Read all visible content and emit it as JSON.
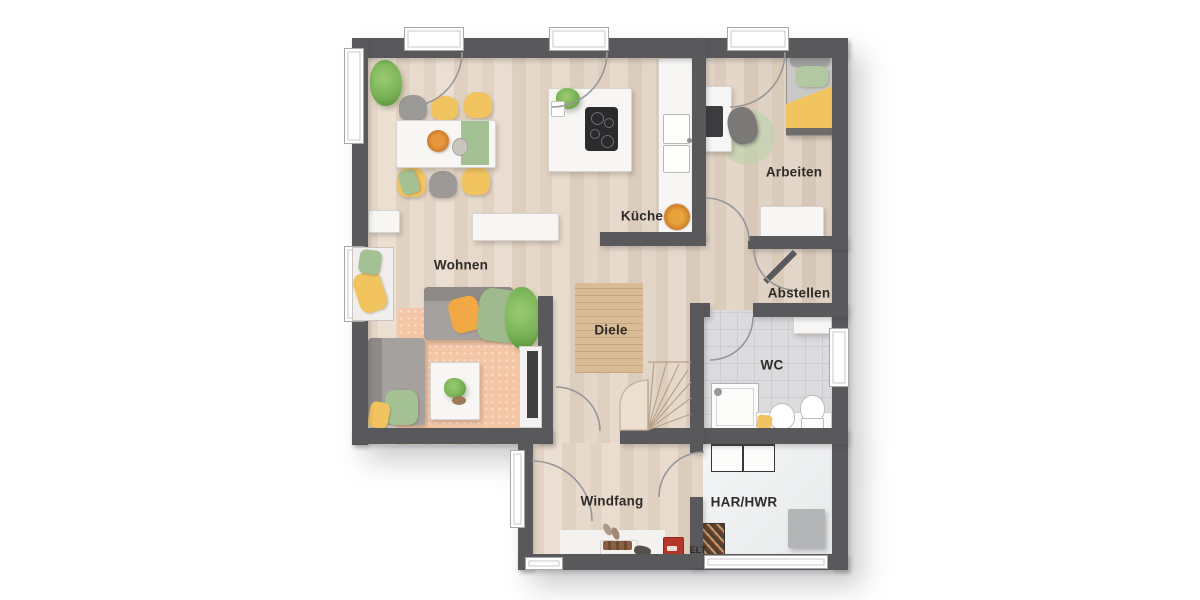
{
  "meta": {
    "type": "floor-plan",
    "level": "ground-floor"
  },
  "rooms": {
    "wohnen": {
      "label": "Wohnen"
    },
    "kueche": {
      "label": "Küche"
    },
    "arbeiten": {
      "label": "Arbeiten"
    },
    "abstellen": {
      "label": "Abstellen"
    },
    "diele": {
      "label": "Diele"
    },
    "wc": {
      "label": "WC"
    },
    "windfang": {
      "label": "Windfang"
    },
    "har_hwr": {
      "label": "HAR/HWR"
    },
    "elt": {
      "label": "ELT"
    }
  },
  "colors": {
    "wall": "#59595c",
    "floor-wood": "#e6d7c8",
    "floor-tile": "#dbdbde",
    "rug-diele": "#d9bb95",
    "rug-living": "#f5c6a6",
    "accent-yellow": "#f2c45f",
    "accent-orange": "#f2a845",
    "accent-green": "#a4c194",
    "plant-green": "#79b356",
    "furniture-white": "#f7f6f4",
    "sofa-gray": "#a5a19e",
    "sofa-gray-dark": "#8e8a87",
    "label-text": "#2f2b28",
    "elt-red": "#b5372a",
    "arc-gray": "#97979a"
  }
}
